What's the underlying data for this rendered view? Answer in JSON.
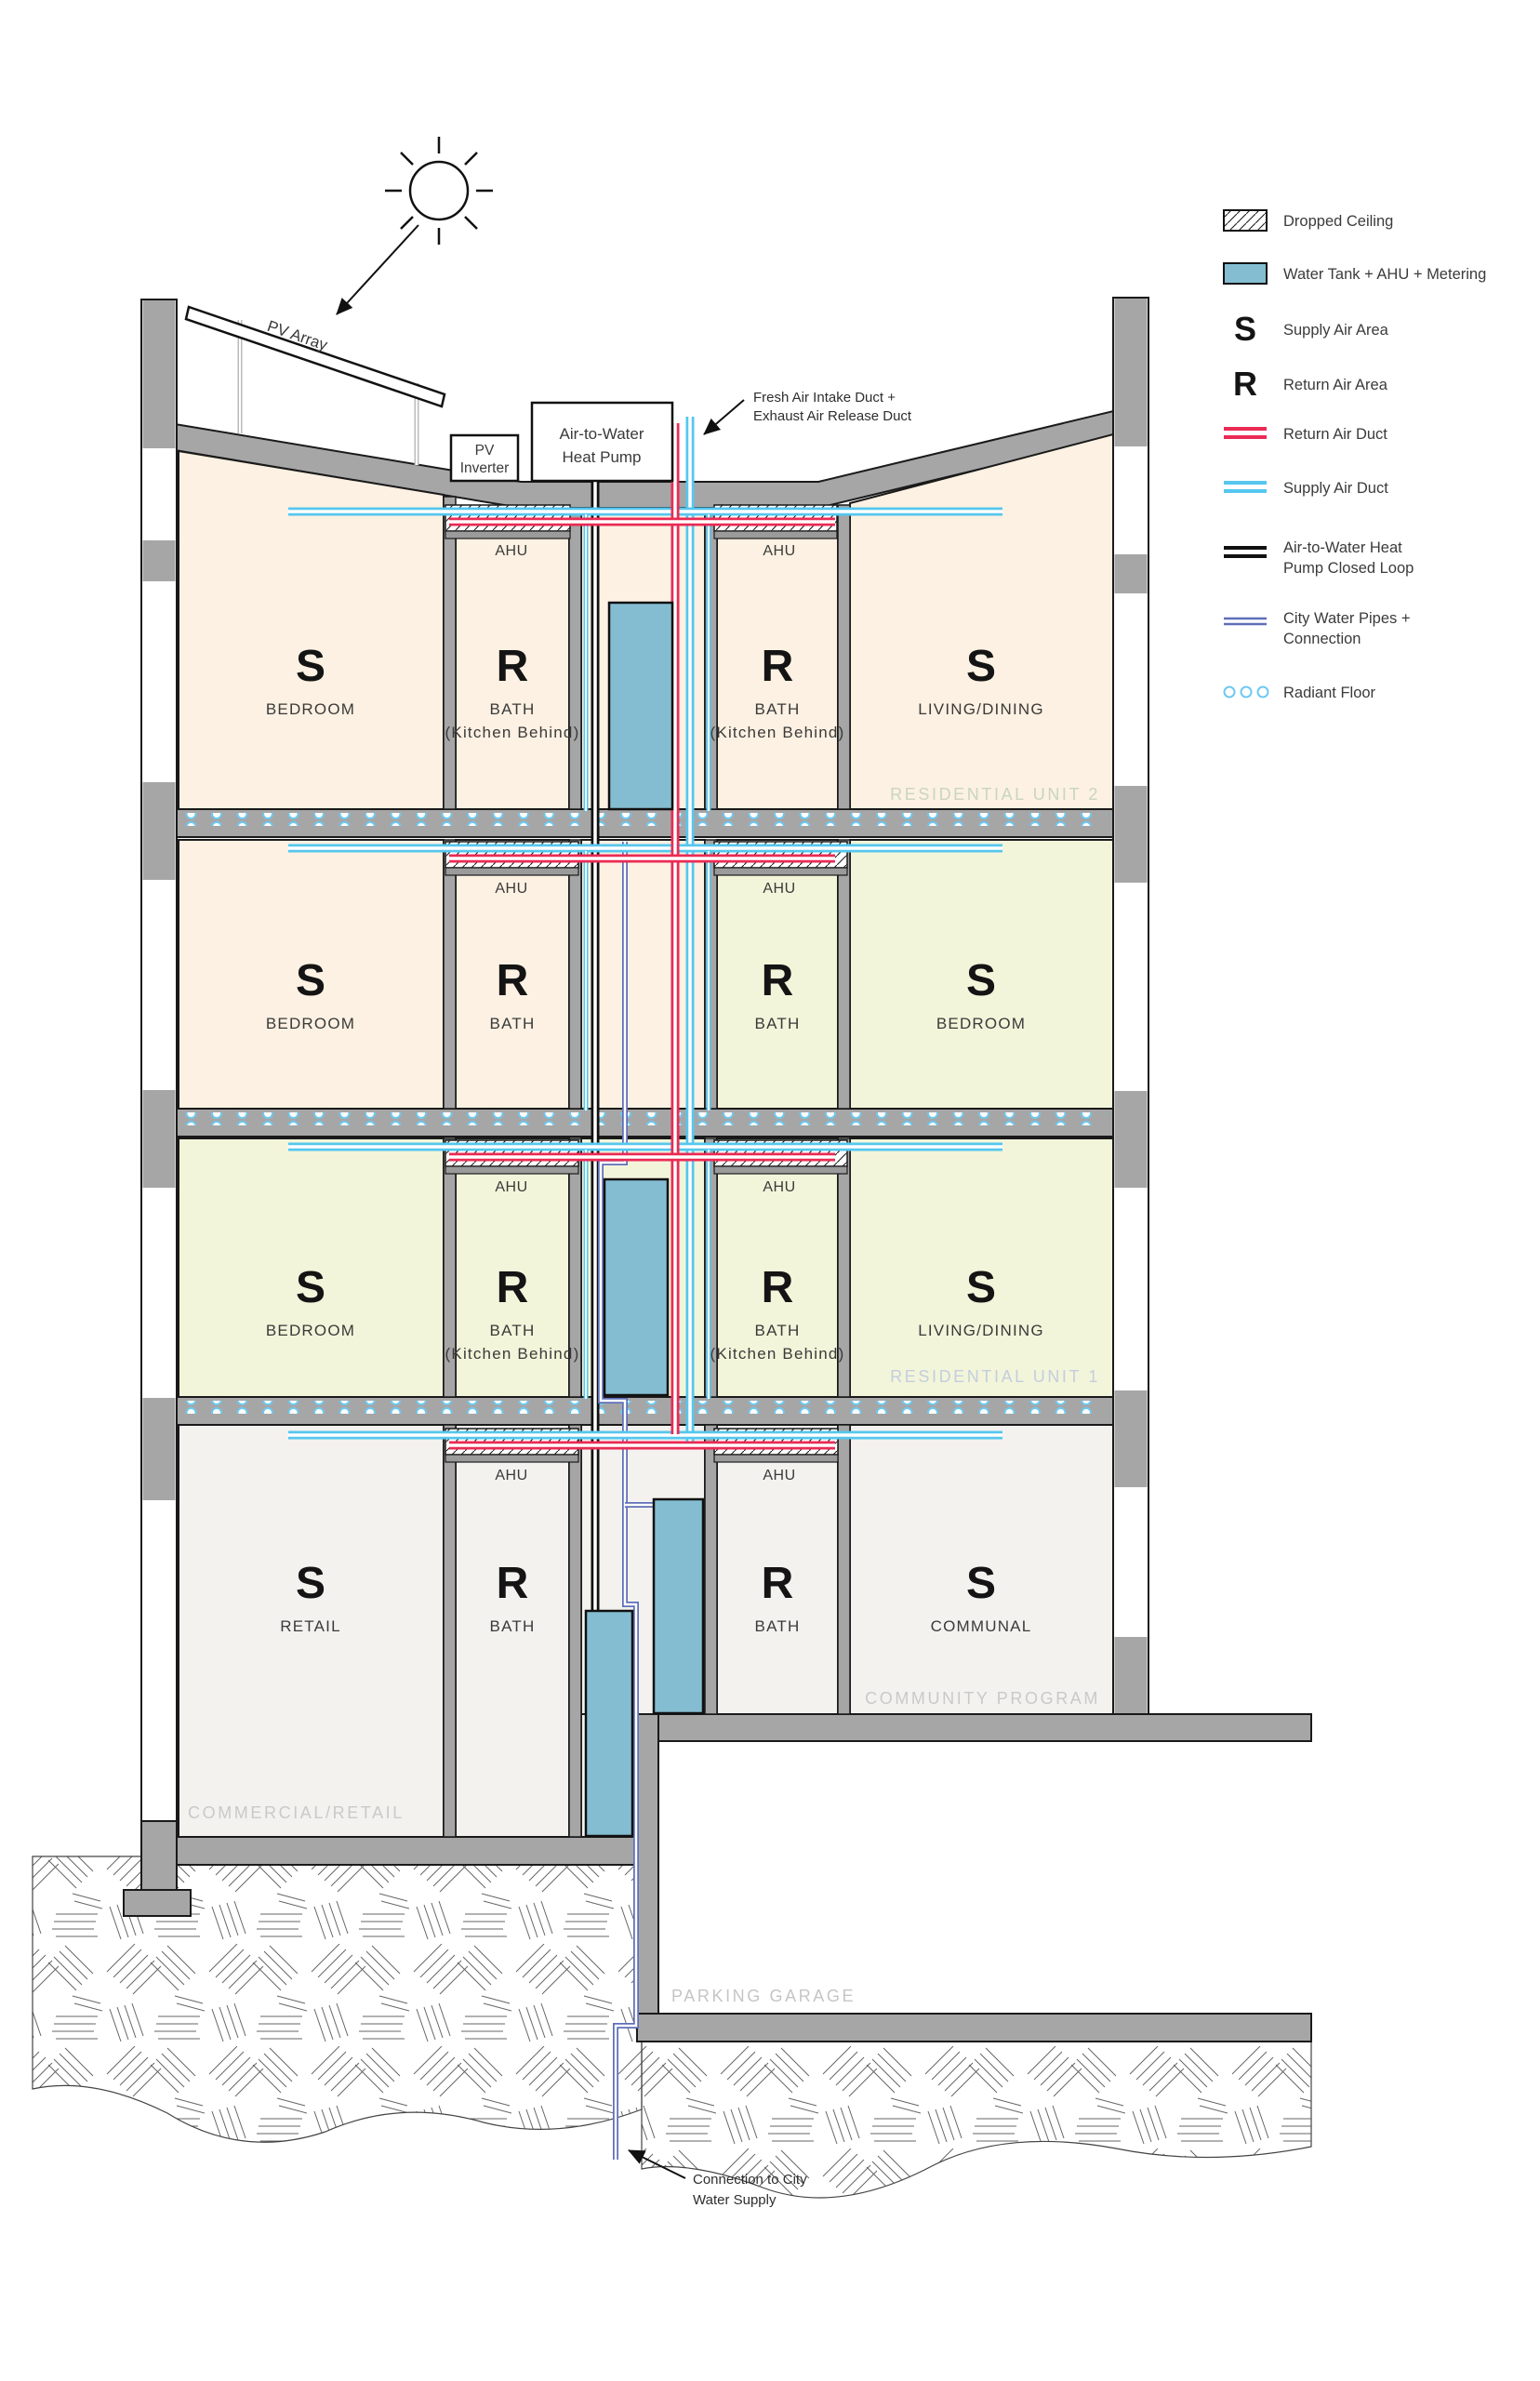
{
  "legend": {
    "items": [
      {
        "id": "dropped-ceiling",
        "label": "Dropped Ceiling"
      },
      {
        "id": "water-tank",
        "label": "Water Tank + AHU + Metering"
      },
      {
        "id": "supply-air-area",
        "symbol": "S",
        "label": "Supply Air Area"
      },
      {
        "id": "return-air-area",
        "symbol": "R",
        "label": "Return Air Area"
      },
      {
        "id": "return-air-duct",
        "label": "Return Air Duct"
      },
      {
        "id": "supply-air-duct",
        "label": "Supply Air Duct"
      },
      {
        "id": "heat-pump-loop",
        "label_line1": "Air-to-Water Heat",
        "label_line2": "Pump Closed Loop"
      },
      {
        "id": "city-water",
        "label_line1": "City Water Pipes +",
        "label_line2": "Connection"
      },
      {
        "id": "radiant-floor",
        "label": "Radiant Floor"
      }
    ]
  },
  "equipment": {
    "pv_array": "PV Array",
    "pv_inverter_line1": "PV",
    "pv_inverter_line2": "Inverter",
    "heat_pump_line1": "Air-to-Water",
    "heat_pump_line2": "Heat Pump",
    "ahu": "AHU"
  },
  "annotations": {
    "fresh_air_line1": "Fresh Air Intake Duct +",
    "fresh_air_line2": "Exhaust Air Release Duct",
    "city_water_line1": "Connection to City",
    "city_water_line2": "Water Supply"
  },
  "floors": [
    {
      "unit_label": "RESIDENTIAL UNIT 2",
      "rooms": [
        {
          "letter": "S",
          "name": "BEDROOM"
        },
        {
          "letter": "R",
          "name": "BATH",
          "name2": "(Kitchen Behind)"
        },
        {
          "letter": "R",
          "name": "BATH",
          "name2": "(Kitchen Behind)"
        },
        {
          "letter": "S",
          "name": "LIVING/DINING"
        }
      ]
    },
    {
      "rooms": [
        {
          "letter": "S",
          "name": "BEDROOM"
        },
        {
          "letter": "R",
          "name": "BATH"
        },
        {
          "letter": "R",
          "name": "BATH"
        },
        {
          "letter": "S",
          "name": "BEDROOM"
        }
      ]
    },
    {
      "unit_label": "RESIDENTIAL UNIT 1",
      "rooms": [
        {
          "letter": "S",
          "name": "BEDROOM"
        },
        {
          "letter": "R",
          "name": "BATH",
          "name2": "(Kitchen Behind)"
        },
        {
          "letter": "R",
          "name": "BATH",
          "name2": "(Kitchen Behind)"
        },
        {
          "letter": "S",
          "name": "LIVING/DINING"
        }
      ]
    },
    {
      "unit_label": "COMMUNITY PROGRAM",
      "zone_label": "COMMERCIAL/RETAIL",
      "rooms": [
        {
          "letter": "S",
          "name": "RETAIL"
        },
        {
          "letter": "R",
          "name": "BATH"
        },
        {
          "letter": "R",
          "name": "BATH"
        },
        {
          "letter": "S",
          "name": "COMMUNAL"
        }
      ]
    }
  ],
  "basement": {
    "label": "PARKING GARAGE"
  },
  "colors": {
    "supply_air": "#56c7ee",
    "return_air": "#ea2b55",
    "heat_pump_loop": "#111111",
    "city_water": "#5f6fb8",
    "water_tank": "#84bdd2",
    "wall_gray": "#a6a6a6",
    "room_peach": "#fcf1e2",
    "room_green": "#f3f5da",
    "room_offwhite": "#f3f2ef",
    "unit2_label": "#c9d5c1",
    "unit1_label": "#c3cede",
    "faint_gray_label": "#c9c9c9"
  }
}
